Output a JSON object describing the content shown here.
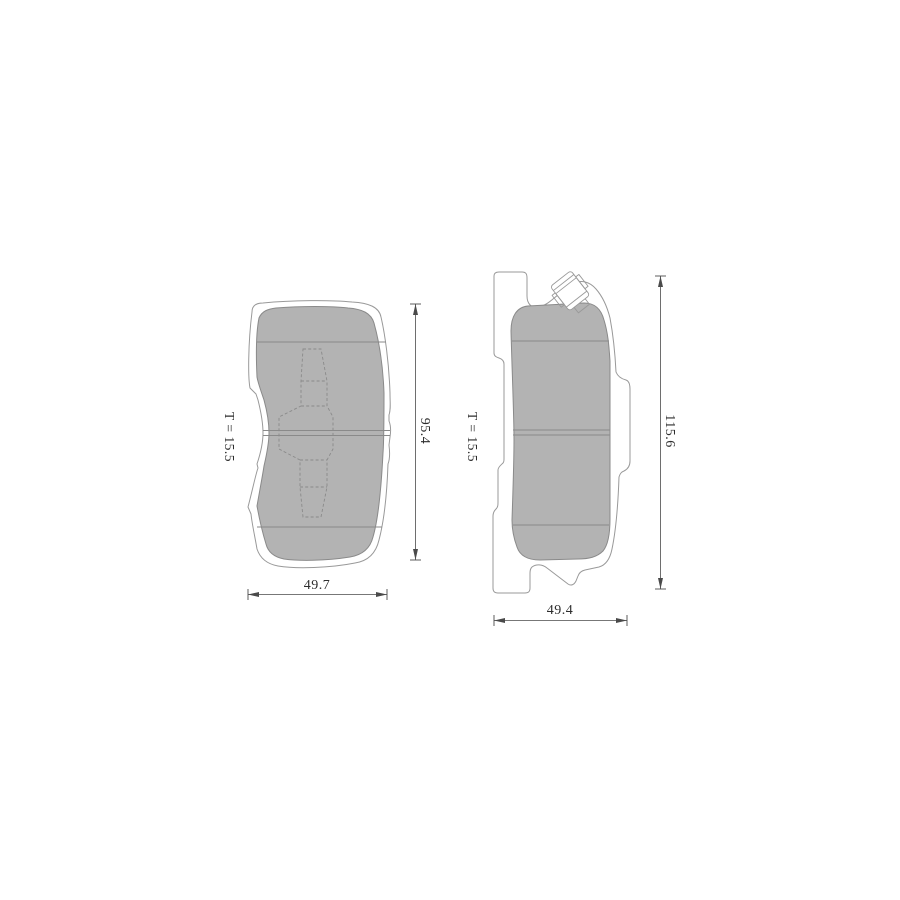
{
  "figure": {
    "left_view": {
      "thickness_label": "T = 15.5",
      "height_dim": "95.4",
      "width_dim": "49.7"
    },
    "right_view": {
      "thickness_label": "T = 15.5",
      "height_dim": "115.6",
      "width_dim": "49.4"
    },
    "colors": {
      "background": "#ffffff",
      "friction": "#b3b3b3",
      "outline": "#999999",
      "detail": "#8a8a8a",
      "dimension": "#4a4a4a",
      "text": "#2d2d2d"
    }
  }
}
